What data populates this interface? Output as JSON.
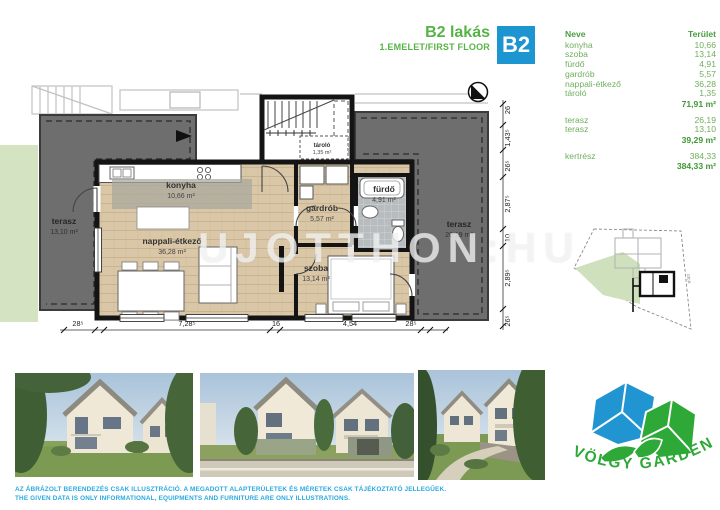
{
  "header": {
    "title": "B2 lakás",
    "subtitle": "1.EMELET/FIRST FLOOR",
    "badge": "B2"
  },
  "table": {
    "header": {
      "name": "Neve",
      "area": "Terület"
    },
    "group1": {
      "rows": [
        {
          "name": "konyha",
          "area": "10,66"
        },
        {
          "name": "szoba",
          "area": "13,14"
        },
        {
          "name": "fürdő",
          "area": "4,91"
        },
        {
          "name": "gardrób",
          "area": "5,57"
        },
        {
          "name": "nappali-étkező",
          "area": "36,28"
        },
        {
          "name": "tároló",
          "area": "1,35"
        }
      ],
      "total": "71,91 m²"
    },
    "group2": {
      "rows": [
        {
          "name": "terasz",
          "area": "26,19"
        },
        {
          "name": "terasz",
          "area": "13,10"
        }
      ],
      "total": "39,29 m²"
    },
    "group3": {
      "rows": [
        {
          "name": "kertrész",
          "area": "384,33"
        }
      ],
      "total": "384,33 m²"
    }
  },
  "plan": {
    "watermark": "UJOTTHON:HU",
    "rooms": {
      "konyha": {
        "name": "konyha",
        "area": "10,66 m²"
      },
      "nappali": {
        "name": "nappali-étkező",
        "area": "36,28 m²"
      },
      "gardrob": {
        "name": "gardrób",
        "area": "5,57 m²"
      },
      "furdo": {
        "name": "fürdő",
        "area": "4,91 m²"
      },
      "szoba": {
        "name": "szoba",
        "area": "13,14 m²"
      },
      "tarolo": {
        "name": "tároló",
        "area": "1,35 m²"
      },
      "terasz_bal": {
        "name": "terasz",
        "area": "13,10 m²"
      },
      "terasz_jobb": {
        "name": "terasz",
        "area": "26,19 m²"
      }
    },
    "dims_bottom": [
      "28⁵",
      "7,28⁵",
      "16",
      "4,54",
      "28⁵"
    ],
    "dims_right": [
      "26",
      "1,43⁵",
      "26⁵",
      "2,87⁵",
      "10",
      "2,89⁵",
      "26⁵"
    ]
  },
  "siteplan": {
    "street": "utca"
  },
  "logo": {
    "text": "VÖLGY GARDEN"
  },
  "disclaimer": {
    "hu": "AZ ÁBRÁZOLT BERENDEZÉS CSAK ILLUSZTRÁCIÓ. A MEGADOTT ALAPTERÜLETEK ÉS MÉRETEK CSAK TÁJÉKOZTATÓ JELLEGŰEK.",
    "en": "THE GIVEN DATA IS ONLY INFORMATIONAL, EQUIPMENTS AND FURNITURE ARE ONLY ILLUSTRATIONS."
  },
  "colors": {
    "accent_green": "#56b345",
    "table_green": "#6fae5c",
    "total_green": "#3f9a33",
    "badge_blue": "#1d95d0",
    "disclaimer_blue": "#2aa9df",
    "terrace_gray": "#6e6e6e",
    "wood": "#d9c7a8",
    "lawn": "#d4e4c3",
    "logo_blue": "#2095d2",
    "logo_green": "#2ea836"
  }
}
